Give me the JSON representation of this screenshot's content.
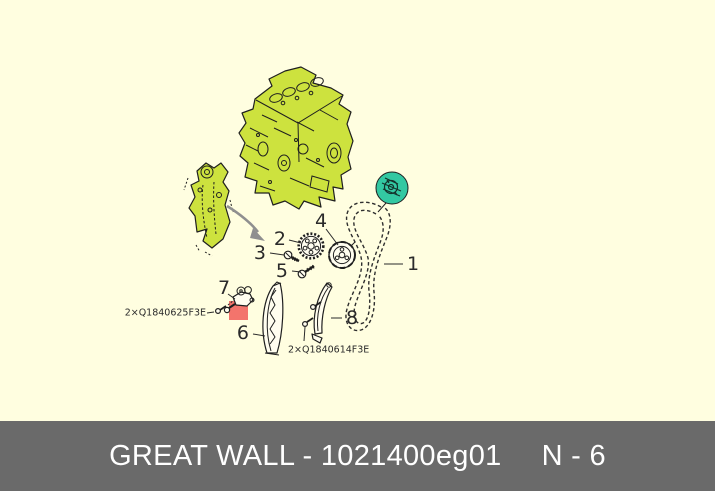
{
  "diagram": {
    "callout_numbers": [
      "1",
      "2",
      "3",
      "4",
      "5",
      "6",
      "7",
      "8"
    ],
    "part_labels": {
      "left_bolt_qty_code": "2×Q1840625F3E",
      "right_bolt_qty_code": "2×Q1840614F3E"
    },
    "highlights": {
      "engine_green": "#cde23e",
      "selected_teal": "#33c8a2",
      "selected_red": "#f3746c"
    }
  },
  "footer": {
    "title": "GREAT WALL - 1021400eg01",
    "page_ref": "N - 6",
    "bar_color": "#6a6a6a",
    "text_color": "#ffffff"
  }
}
